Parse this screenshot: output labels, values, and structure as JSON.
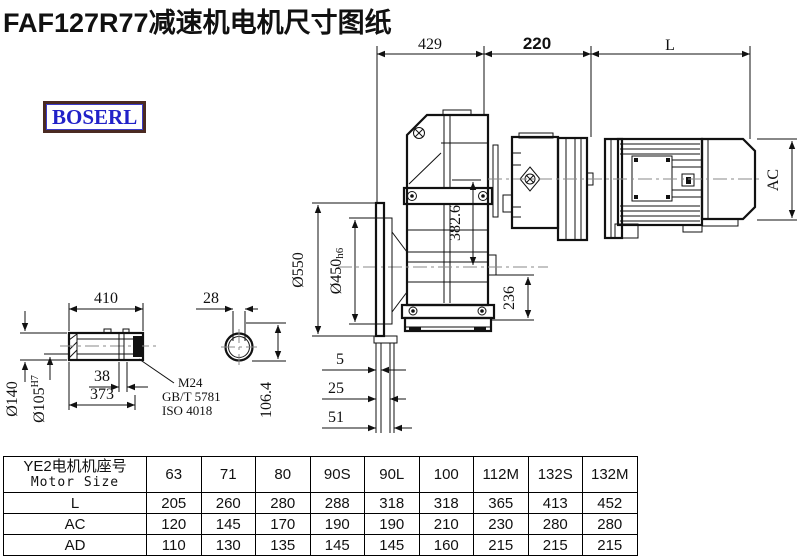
{
  "page": {
    "title": "FAF127R77减速机电机尺寸图纸"
  },
  "brand": {
    "logo_text": "BOSERL"
  },
  "colors": {
    "logo_text": "#2121c8",
    "logo_border": "#4a2a22",
    "line": "#111111",
    "centerline": "#8a8a8a"
  },
  "drawing": {
    "top_dims": {
      "d429": "429",
      "d220": "220",
      "dL": "L"
    },
    "motor_dims": {
      "ac": "AC"
    },
    "flange_dims": {
      "d550": "Ø550",
      "d450": "Ø450",
      "d450_suffix": "h6"
    },
    "housing_dims": {
      "v382": "382.6",
      "v236": "236"
    },
    "face_dims": {
      "b5": "5",
      "b25": "25",
      "b51": "51"
    },
    "shaft_detail": {
      "d410": "410",
      "d28": "28",
      "d140": "Ø140",
      "d105": "Ø105",
      "d105_suffix": "H7",
      "w38": "38",
      "w373": "373",
      "leader1": "M24",
      "leader2": "GB/T 5781",
      "leader3": "ISO 4018",
      "v106": "106.4"
    }
  },
  "table": {
    "header": {
      "line1": "YE2电机机座号",
      "line2": "Motor Size"
    },
    "columns": [
      "63",
      "71",
      "80",
      "90S",
      "90L",
      "100",
      "112M",
      "132S",
      "132M"
    ],
    "rows": [
      {
        "label": "L",
        "values": [
          "205",
          "260",
          "280",
          "288",
          "318",
          "318",
          "365",
          "413",
          "452"
        ]
      },
      {
        "label": "AC",
        "values": [
          "120",
          "145",
          "170",
          "190",
          "190",
          "210",
          "230",
          "280",
          "280"
        ]
      },
      {
        "label": "AD",
        "values": [
          "110",
          "130",
          "135",
          "145",
          "145",
          "160",
          "215",
          "215",
          "215"
        ]
      }
    ]
  }
}
